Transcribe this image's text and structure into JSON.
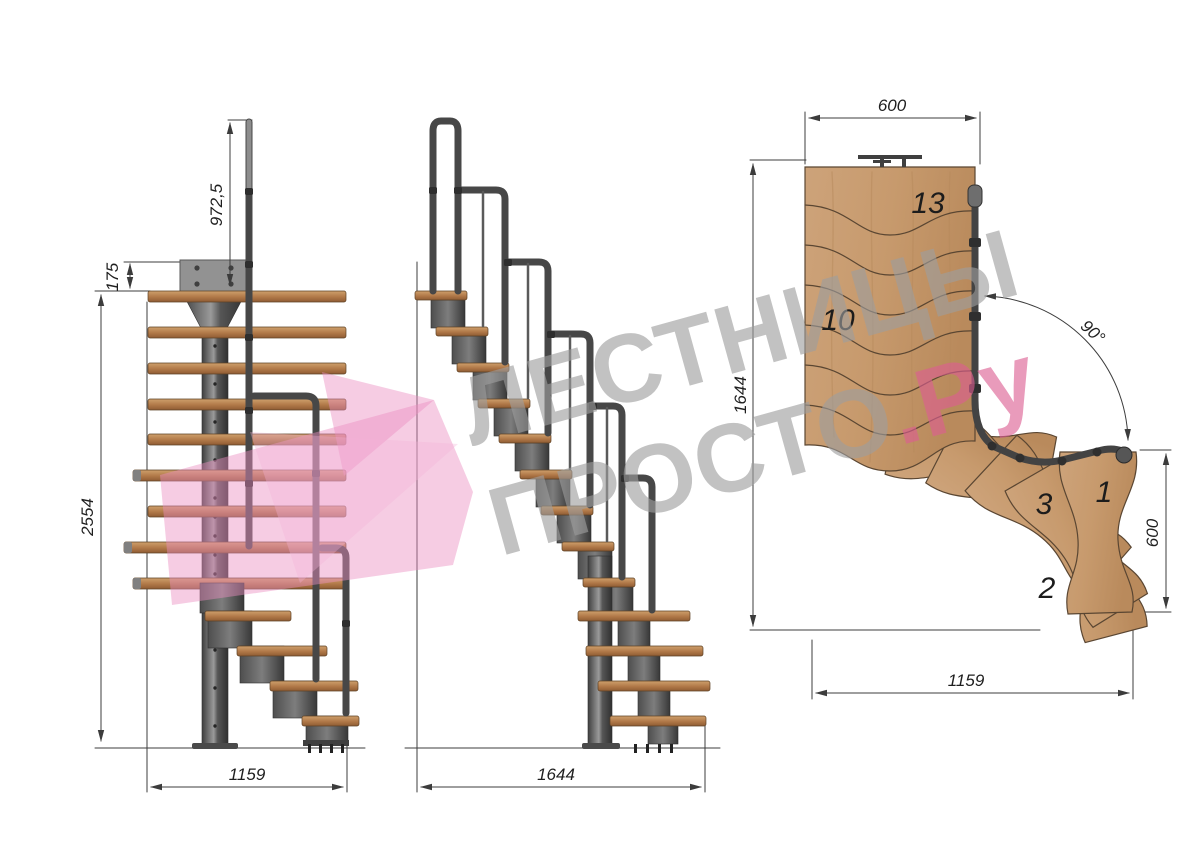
{
  "watermark": {
    "line1": "ЛЕСТНИЦЫ",
    "line2": "ПРОСТО",
    "suffix": ".Ру",
    "gray": "#a0a0a0",
    "pink": "#dd5e92",
    "arrow_pink": "#ec8fc2"
  },
  "front_view": {
    "dim_rail_height": "972,5",
    "dim_plate_offset": "175",
    "dim_total_height": "2554",
    "dim_width": "1159"
  },
  "side_view": {
    "dim_length": "1644"
  },
  "plan_view": {
    "dim_top_width": "600",
    "dim_length": "1644",
    "dim_turn_angle": "90°",
    "dim_side_width": "600",
    "dim_bottom_width": "1159",
    "tread_labels": {
      "top": "13",
      "middle": "10",
      "turn3": "3",
      "turn1": "1",
      "turn2": "2"
    }
  },
  "colors": {
    "background": "#ffffff",
    "wood": "#b97f52",
    "wood_plan": "#c79a6d",
    "wood_edge": "#5a4632",
    "steel": "#4a4a4a",
    "steel_light": "#9a9a9a",
    "dim_line": "#3c3c3c"
  }
}
